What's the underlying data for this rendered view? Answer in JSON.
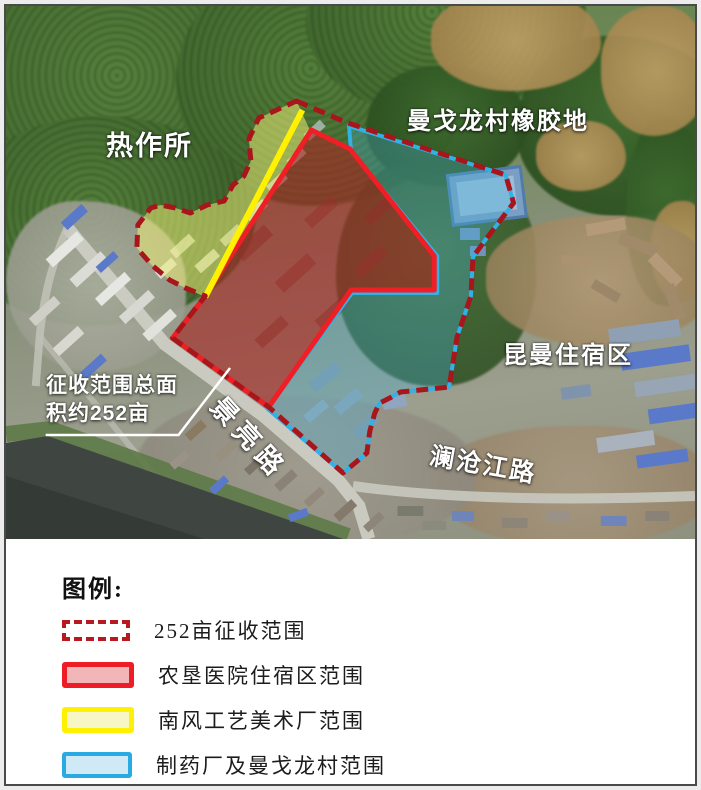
{
  "map": {
    "area_labels": [
      {
        "text": "热作所"
      },
      {
        "text": "曼戈龙村橡胶地"
      },
      {
        "text": "昆曼住宿区"
      }
    ],
    "road_labels": [
      {
        "text": "景亮路"
      },
      {
        "text": "澜沧江路"
      }
    ],
    "callout": {
      "line1": "征收范围总面",
      "line2": "积约252亩"
    }
  },
  "legend": {
    "title": "图例:",
    "items": [
      {
        "label": "252亩征收范围",
        "style": "dashed-outline",
        "stroke": "#b8191f",
        "fill": "#ffffff"
      },
      {
        "label": "农垦医院住宿区范围",
        "style": "solid",
        "stroke": "#ee1c25",
        "fill": "#f2b6b9"
      },
      {
        "label": "南风工艺美术厂范围",
        "style": "solid",
        "stroke": "#fff100",
        "fill": "#f6f6c6"
      },
      {
        "label": "制药厂及曼戈龙村范围",
        "style": "solid",
        "stroke": "#29aae2",
        "fill": "#cfe9f6"
      }
    ]
  },
  "zones": {
    "acquisition_boundary": {
      "name": "252亩征收范围",
      "stroke": "#a8151b",
      "line_style": "dashed"
    },
    "hospital_zone": {
      "name": "农垦医院住宿区范围",
      "stroke": "#f01e25"
    },
    "craft_factory_zone": {
      "name": "南风工艺美术厂范围",
      "stroke": "#fff100"
    },
    "pharma_village_zone": {
      "name": "制药厂及曼戈龙村范围",
      "stroke": "#30b2e6"
    }
  }
}
